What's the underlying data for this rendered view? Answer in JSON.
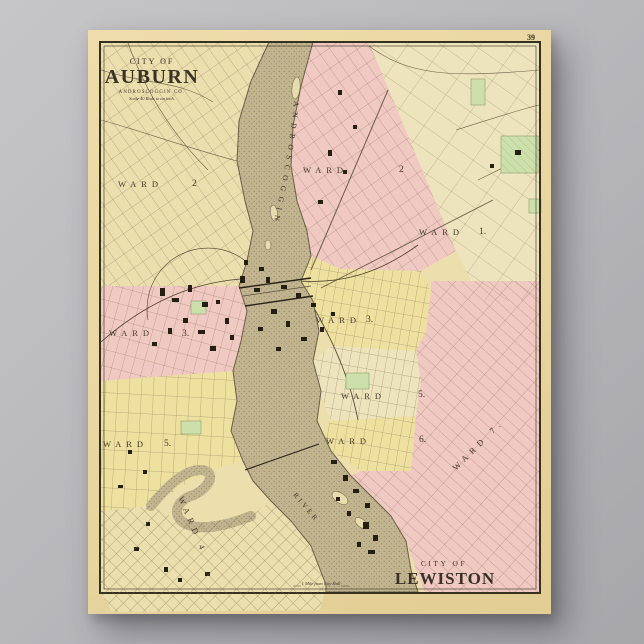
{
  "page_number": "39",
  "titles": {
    "auburn": {
      "prefix": "CITY OF",
      "name": "AUBURN",
      "county": "ANDROSCOGGIN CO.",
      "scale": "Scale 40 Rods to an inch."
    },
    "lewiston": {
      "prefix": "CITY OF",
      "name": "LEWISTON"
    }
  },
  "river": {
    "name": "ANDROSCOGGIN",
    "suffix": "RIVER"
  },
  "note": "1 Mile from City Hall",
  "wards": {
    "auburn": [
      {
        "label": "WARD",
        "number": "2"
      },
      {
        "label": "WARD",
        "number": "3."
      },
      {
        "label": "WARD",
        "number": "5."
      },
      {
        "label": "WARD 4"
      }
    ],
    "lewiston": [
      {
        "label": "WARD",
        "number": "2"
      },
      {
        "label": "WARD",
        "number": "1."
      },
      {
        "label": "WARD",
        "number": "3."
      },
      {
        "label": "WARD",
        "number": "5."
      },
      {
        "label": "WARD",
        "number": "6."
      },
      {
        "label": "WARD 7."
      }
    ]
  },
  "colors": {
    "backdrop": "#b6b6b9",
    "paper": "#e9d7a3",
    "map_bg": "#ecdfad",
    "pink": "#f1c9c3",
    "yellow": "#eee09f",
    "cream": "#ebdfae",
    "cream_light": "#ede3bc",
    "green": "#cde0ab",
    "river": "#c1b48e",
    "ink": "#3a3126"
  }
}
